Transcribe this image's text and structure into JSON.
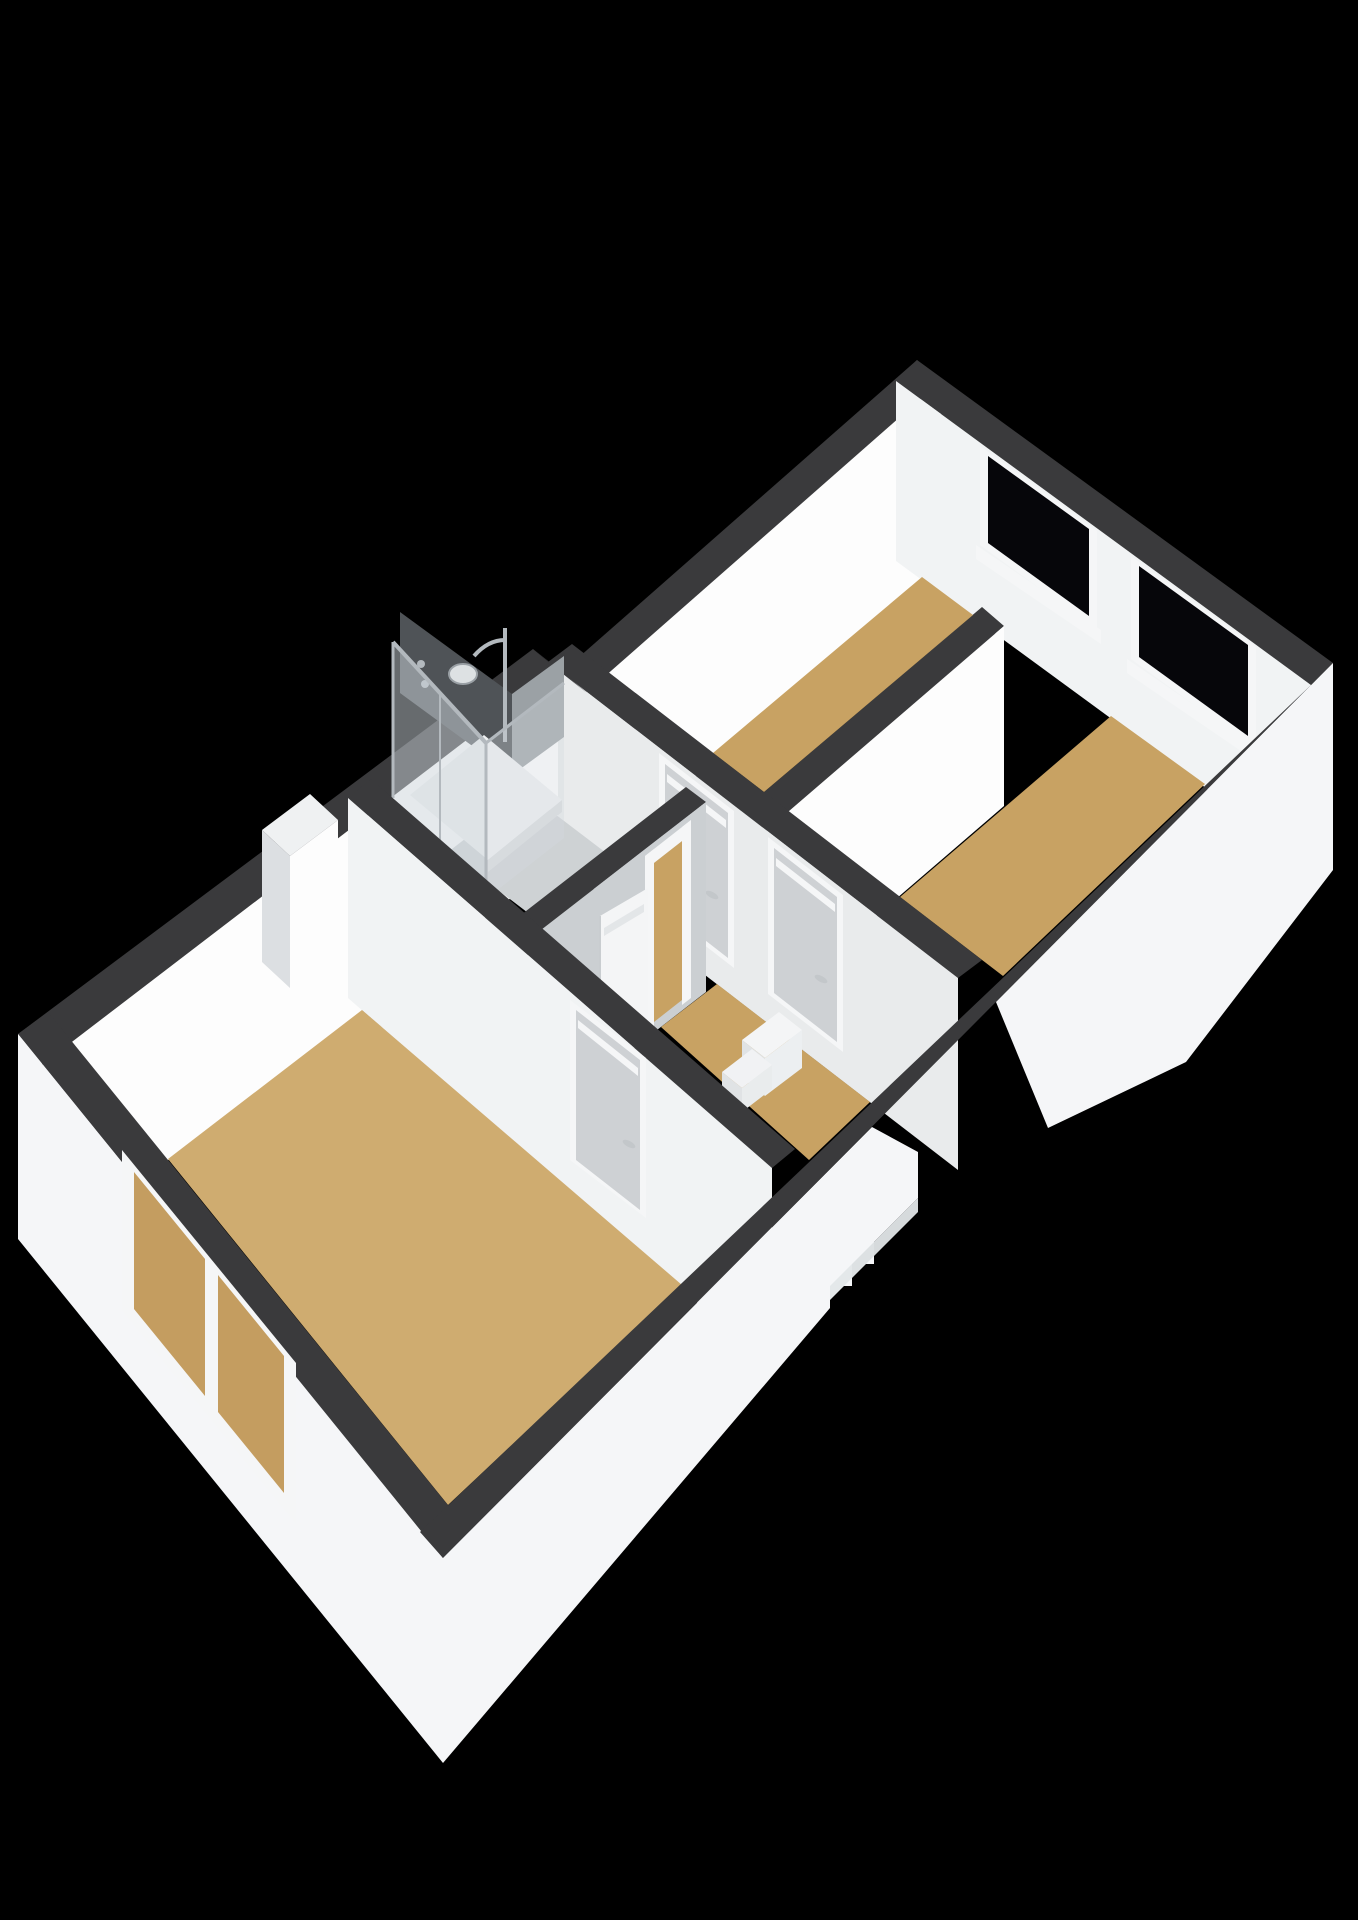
{
  "scene": {
    "type": "3d-floorplan-render",
    "view": "isometric-from-southeast",
    "background": "#000000",
    "floor_shown": "upper floor with two small bedrooms, one large bedroom, bathroom with shower, landing with staircase"
  },
  "palette": {
    "background": "#000000",
    "wall_top_band": "#3a3a3c",
    "wall_white": "#fdfdfd",
    "wall_white_dim": "#f1f3f4",
    "wall_light": "#e9ebec",
    "wall_gray": "#cbcfd2",
    "wall_gray_dark": "#c3c7ca",
    "door_panel": "#ced1d4",
    "frame_white": "#f5f6f7",
    "floor_wood": "#c8a263",
    "floor_wood_light": "#cfac70",
    "floor_wood_window": "#c49d60",
    "floor_bathroom": "#ced2d4",
    "window_glass": "#06060a",
    "shower_glass": "rgba(206,213,219,0.5)",
    "shower_glass_side": "rgba(212,218,223,0.35)",
    "shower_back_dark": "#4f5357",
    "shower_back_gray": "#9ba1a5",
    "chrome": "#b3b9be",
    "tray_white": "#eef0f1",
    "exterior_white": "#f5f6f8",
    "exterior_shadow": "#e7eaec",
    "step_white": "#f4f5f6",
    "step_shade": "#e0e3e5"
  },
  "structure": {
    "rooms": [
      {
        "id": "bedroom-northeast-left",
        "floor": "wood",
        "window": "northeast wall"
      },
      {
        "id": "bedroom-northeast-right",
        "floor": "wood",
        "window": "northeast wall"
      },
      {
        "id": "bedroom-southwest-large",
        "floor": "wood",
        "window": "southwest wall",
        "feature": "chimney-breast"
      },
      {
        "id": "bathroom",
        "floor": "tile",
        "feature": "glass-shower-enclosure"
      },
      {
        "id": "landing-hall",
        "floor": "wood",
        "feature": "staircase-down"
      }
    ],
    "windows_count": 3,
    "interior_doors_count": 4,
    "open_doors_count": 1,
    "staircase": "descends through southeast wall"
  }
}
